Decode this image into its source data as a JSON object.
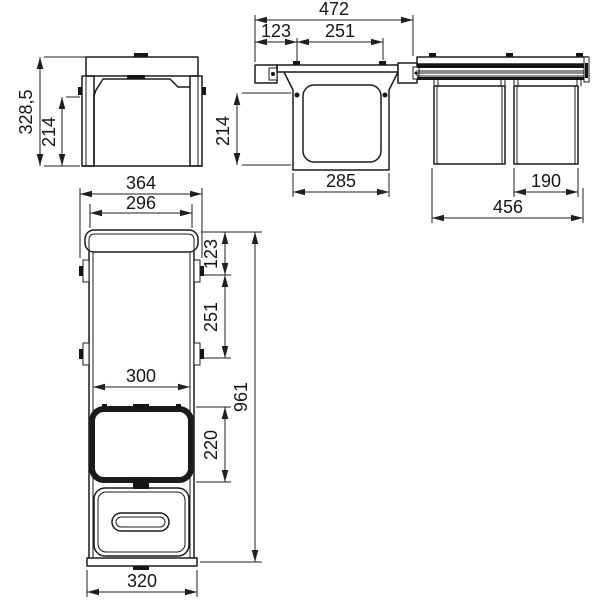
{
  "colors": {
    "line": "#1b1b1b",
    "background": "#ffffff"
  },
  "views": {
    "front": {
      "dims": {
        "total_height": "328,5",
        "inner_height": "214"
      }
    },
    "side_section": {
      "dims": {
        "total_depth": "472",
        "front_offset": "123",
        "hole_spacing": "251",
        "inner_height": "214",
        "frame_depth": "285"
      }
    },
    "bins_side": {
      "dims": {
        "bin_width": "190",
        "total_width": "456"
      }
    },
    "plan": {
      "dims": {
        "outer_width": "364",
        "inner_width": "296",
        "front_offset": "123",
        "hole_spacing": "251",
        "opening_width": "300",
        "opening_depth": "220",
        "total_depth": "961",
        "bottom_width": "320"
      }
    }
  }
}
